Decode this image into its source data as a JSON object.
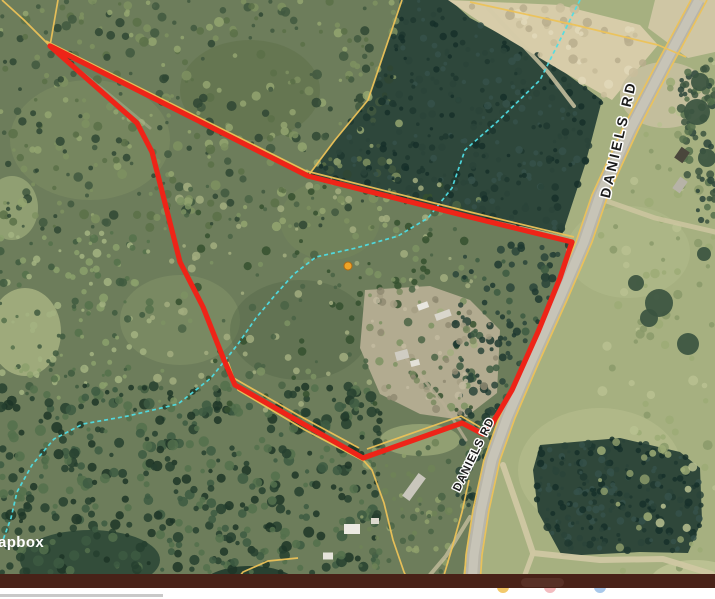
{
  "map": {
    "attribution": "apbox",
    "labels": [
      {
        "id": "daniels-rd-north",
        "text": "DANIELS RD"
      },
      {
        "id": "daniels-rd-south",
        "text": "DANIELS RD"
      }
    ],
    "marker": {
      "name": "orange-point-marker",
      "color": "#eda428"
    },
    "colors": {
      "boundary": "#ee2418",
      "parcel_line": "#ecc258",
      "stream": "#4fdde4",
      "road_fill": "#b8b5a9",
      "road_inner": "#c7c4b7",
      "road_label_text": "#1b1b1b",
      "road_label_halo": "#ffffff",
      "attribution_text": "#ffffff",
      "bottom_bar": "#482218",
      "dock_highlight": "#573026"
    }
  },
  "dock": {
    "icons": [
      {
        "name": "yellow-app-icon",
        "color": "#f3c96b"
      },
      {
        "name": "pink-app-icon",
        "color": "#f2bcc0"
      },
      {
        "name": "blue-app-icon",
        "color": "#a9c8ea"
      }
    ]
  }
}
